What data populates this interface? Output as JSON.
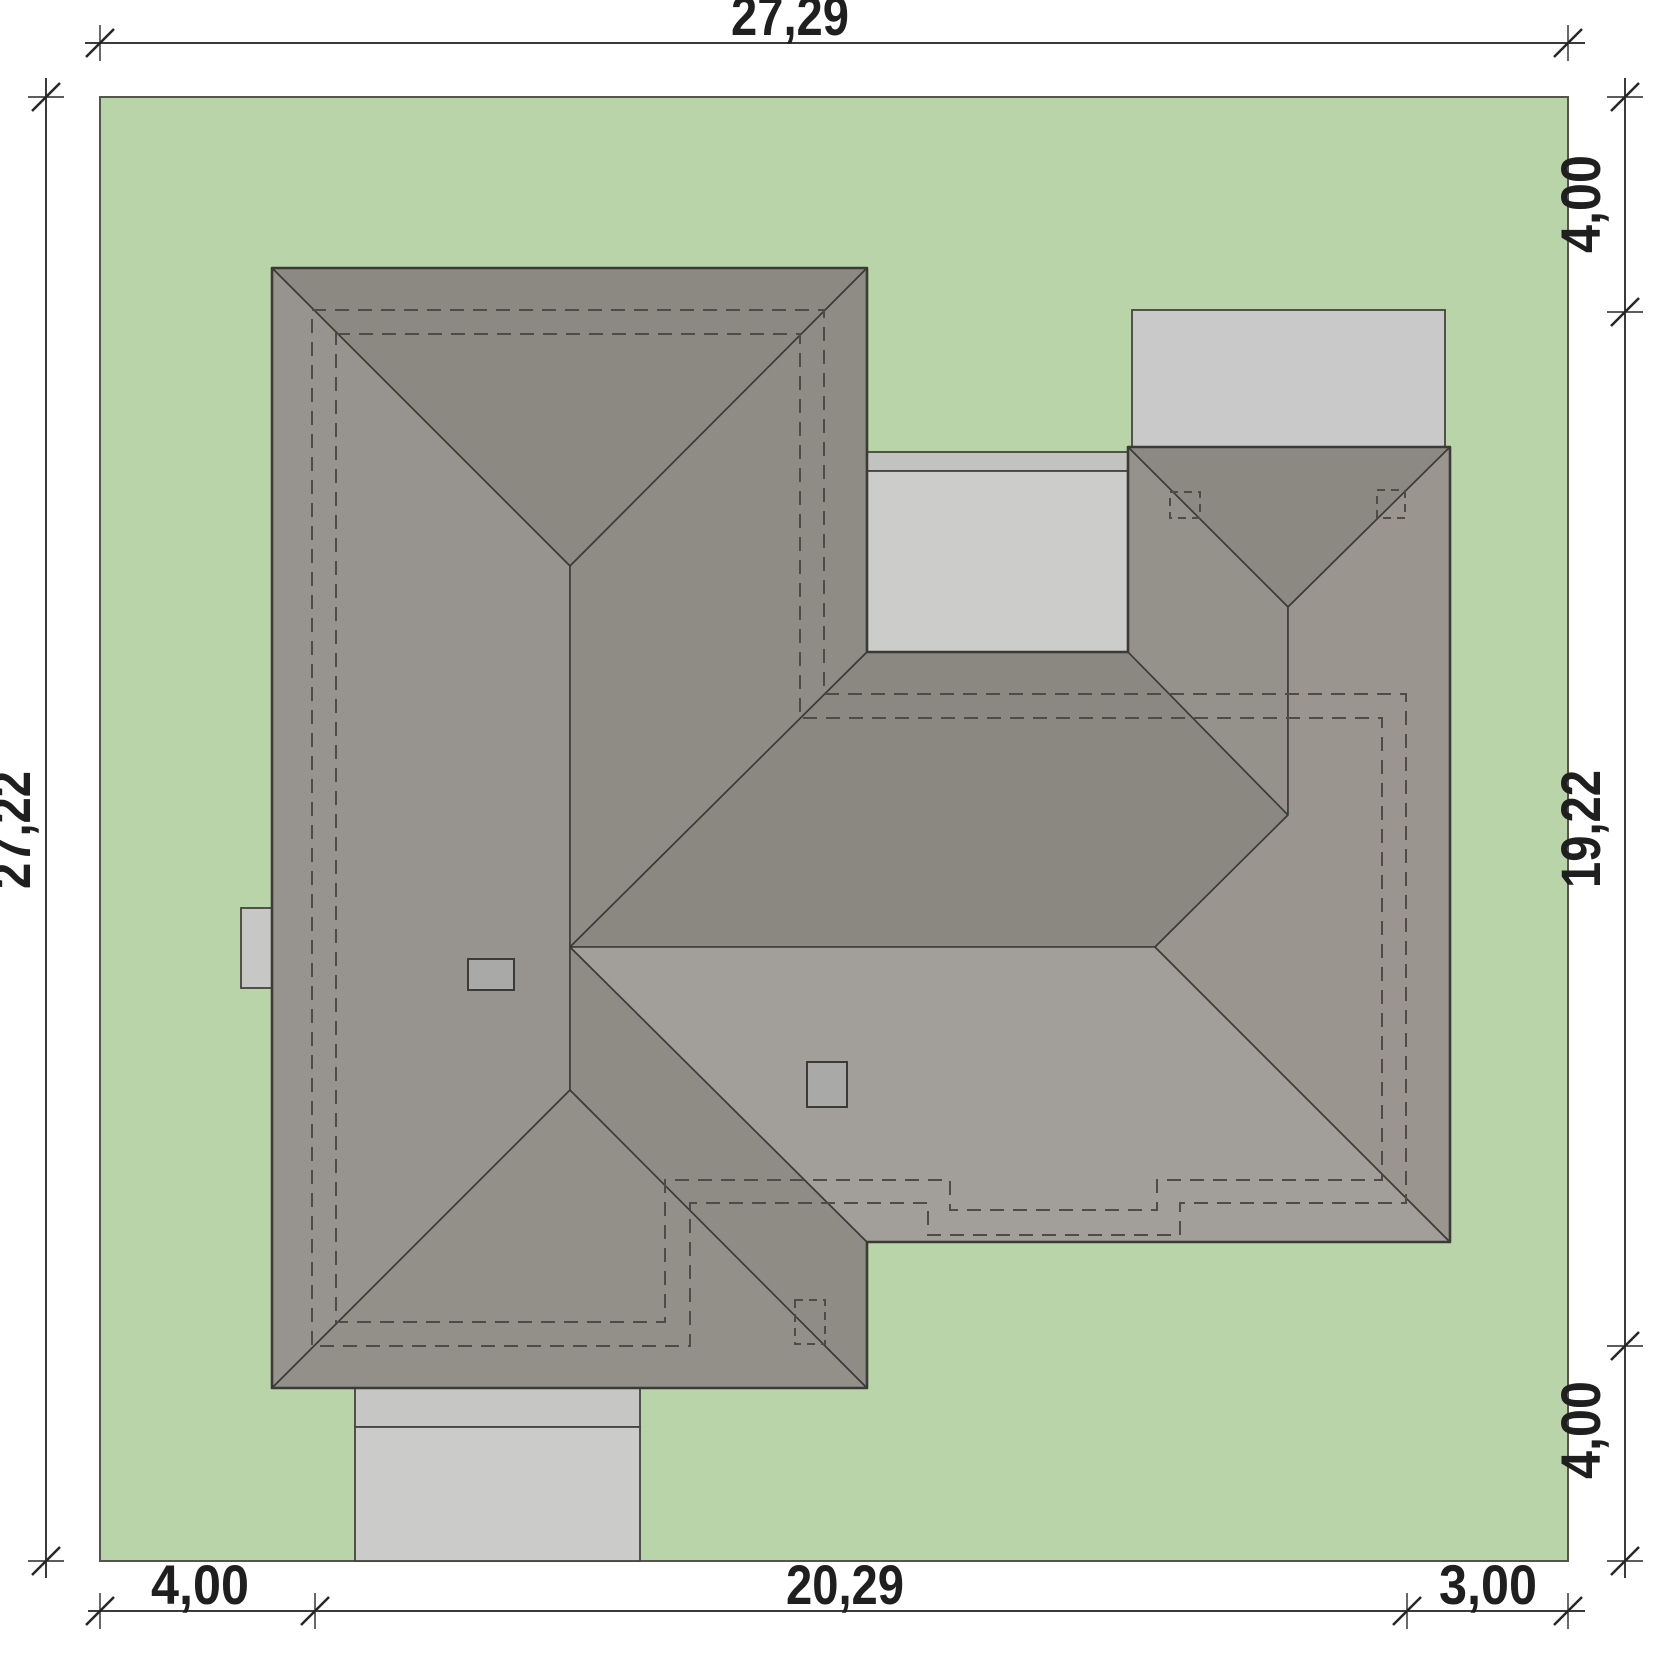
{
  "drawing": {
    "kind": "architectural site plan – roof top view",
    "dims": {
      "top": [
        "27,29"
      ],
      "left": [
        "27,22"
      ],
      "right": [
        "4,00",
        "19,22",
        "4,00"
      ],
      "bottom": [
        "4,00",
        "20,29",
        "3,00"
      ]
    },
    "colors": {
      "plot": "#b9d4a8",
      "plot_border": "#55554e",
      "line": "#3b3a36",
      "dash": "#4e4c47",
      "face_north": "#8c8983",
      "face_west": "#97938e",
      "face_east": "#8f8b85",
      "face_south_small": "#93908a",
      "face_valley_north": "#8b8882",
      "face_south_main": "#a29e99",
      "face_garage_west": "#95918b",
      "face_east_main": "#9a968f",
      "terrace": "#cccdcb",
      "terrace_step": "#c2c3c1",
      "terrace_top": "#c8c9c8",
      "driveway": "#cbcbc9",
      "driveway_step": "#c6c6c4",
      "bump": "#c7c7c5",
      "chimney": "#a9a9a7",
      "text": "#1f1f1f"
    }
  }
}
